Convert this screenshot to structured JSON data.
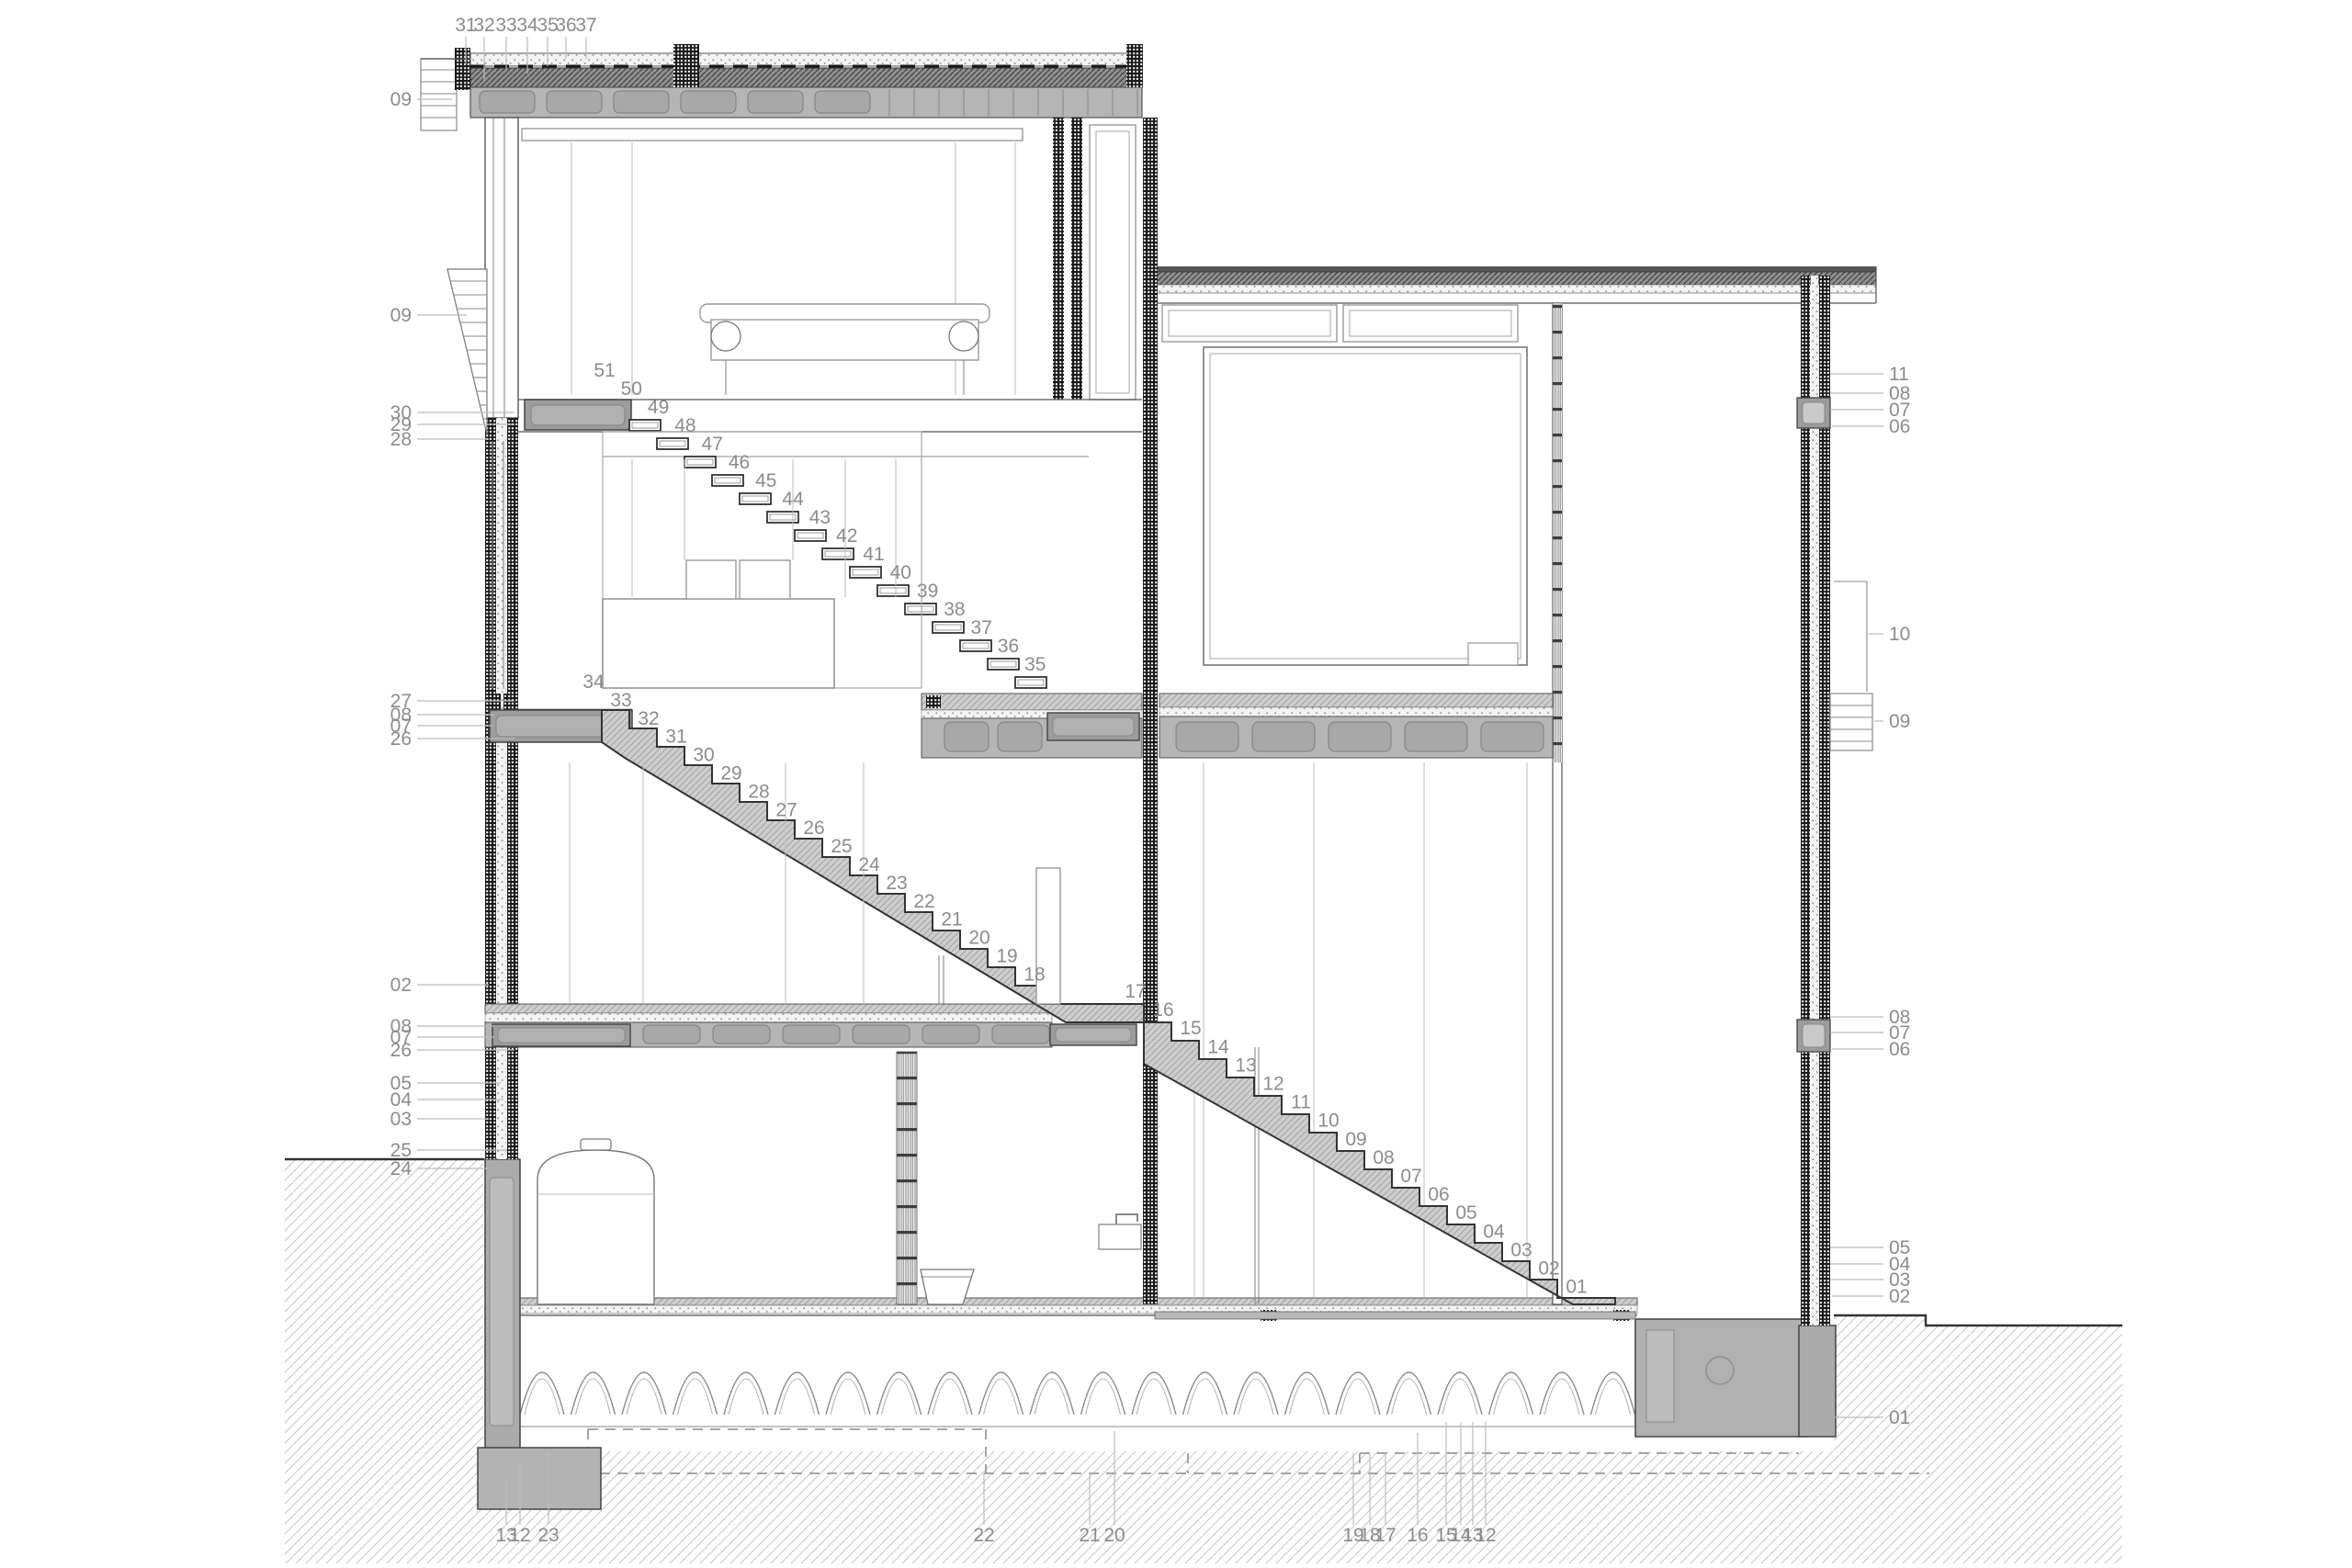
{
  "drawing": {
    "kind": "architectural cross-section",
    "callouts": {
      "top": [
        "31",
        "32",
        "33",
        "34",
        "35",
        "36",
        "37"
      ],
      "left": [
        "09",
        "09",
        "30",
        "29",
        "28",
        "27",
        "08",
        "07",
        "26",
        "02",
        "08",
        "07",
        "26",
        "05",
        "04",
        "03",
        "25",
        "24"
      ],
      "right": [
        "11",
        "08",
        "07",
        "06",
        "10",
        "09",
        "08",
        "07",
        "06",
        "05",
        "04",
        "03",
        "02",
        "01"
      ],
      "bottom": [
        "13",
        "12",
        "23",
        "22",
        "21",
        "20",
        "19",
        "18",
        "17",
        "16",
        "15",
        "14",
        "13",
        "12"
      ]
    },
    "stair_step_labels": {
      "upper_flight": [
        "51",
        "50",
        "49",
        "48",
        "47",
        "46",
        "45",
        "44",
        "43",
        "42",
        "41",
        "40",
        "39",
        "38",
        "37",
        "36",
        "35"
      ],
      "middle_flight": [
        "34",
        "33",
        "32",
        "31",
        "30",
        "29",
        "28",
        "27",
        "26",
        "25",
        "24",
        "23",
        "22",
        "21",
        "20",
        "19",
        "18"
      ],
      "lower_flight": [
        "17",
        "16",
        "15",
        "14",
        "13",
        "12",
        "11",
        "10",
        "09",
        "08",
        "07",
        "06",
        "05",
        "04",
        "03",
        "02",
        "01"
      ]
    },
    "colors": {
      "paper": "#ffffff",
      "line": "#555555",
      "outline_dark": "#333333",
      "label_text": "#8c8c8c",
      "slab_gray": "#b5b5b5",
      "box_gray": "#9c9c9c",
      "stair_hatch_fill": "#cdcdcd",
      "wall_check_dark": "#1b1b1b",
      "below_grade_wall": "#ababab",
      "ground_hatch_line": "#c6c6c6",
      "gravel_fill": "#8f8f8f"
    }
  }
}
